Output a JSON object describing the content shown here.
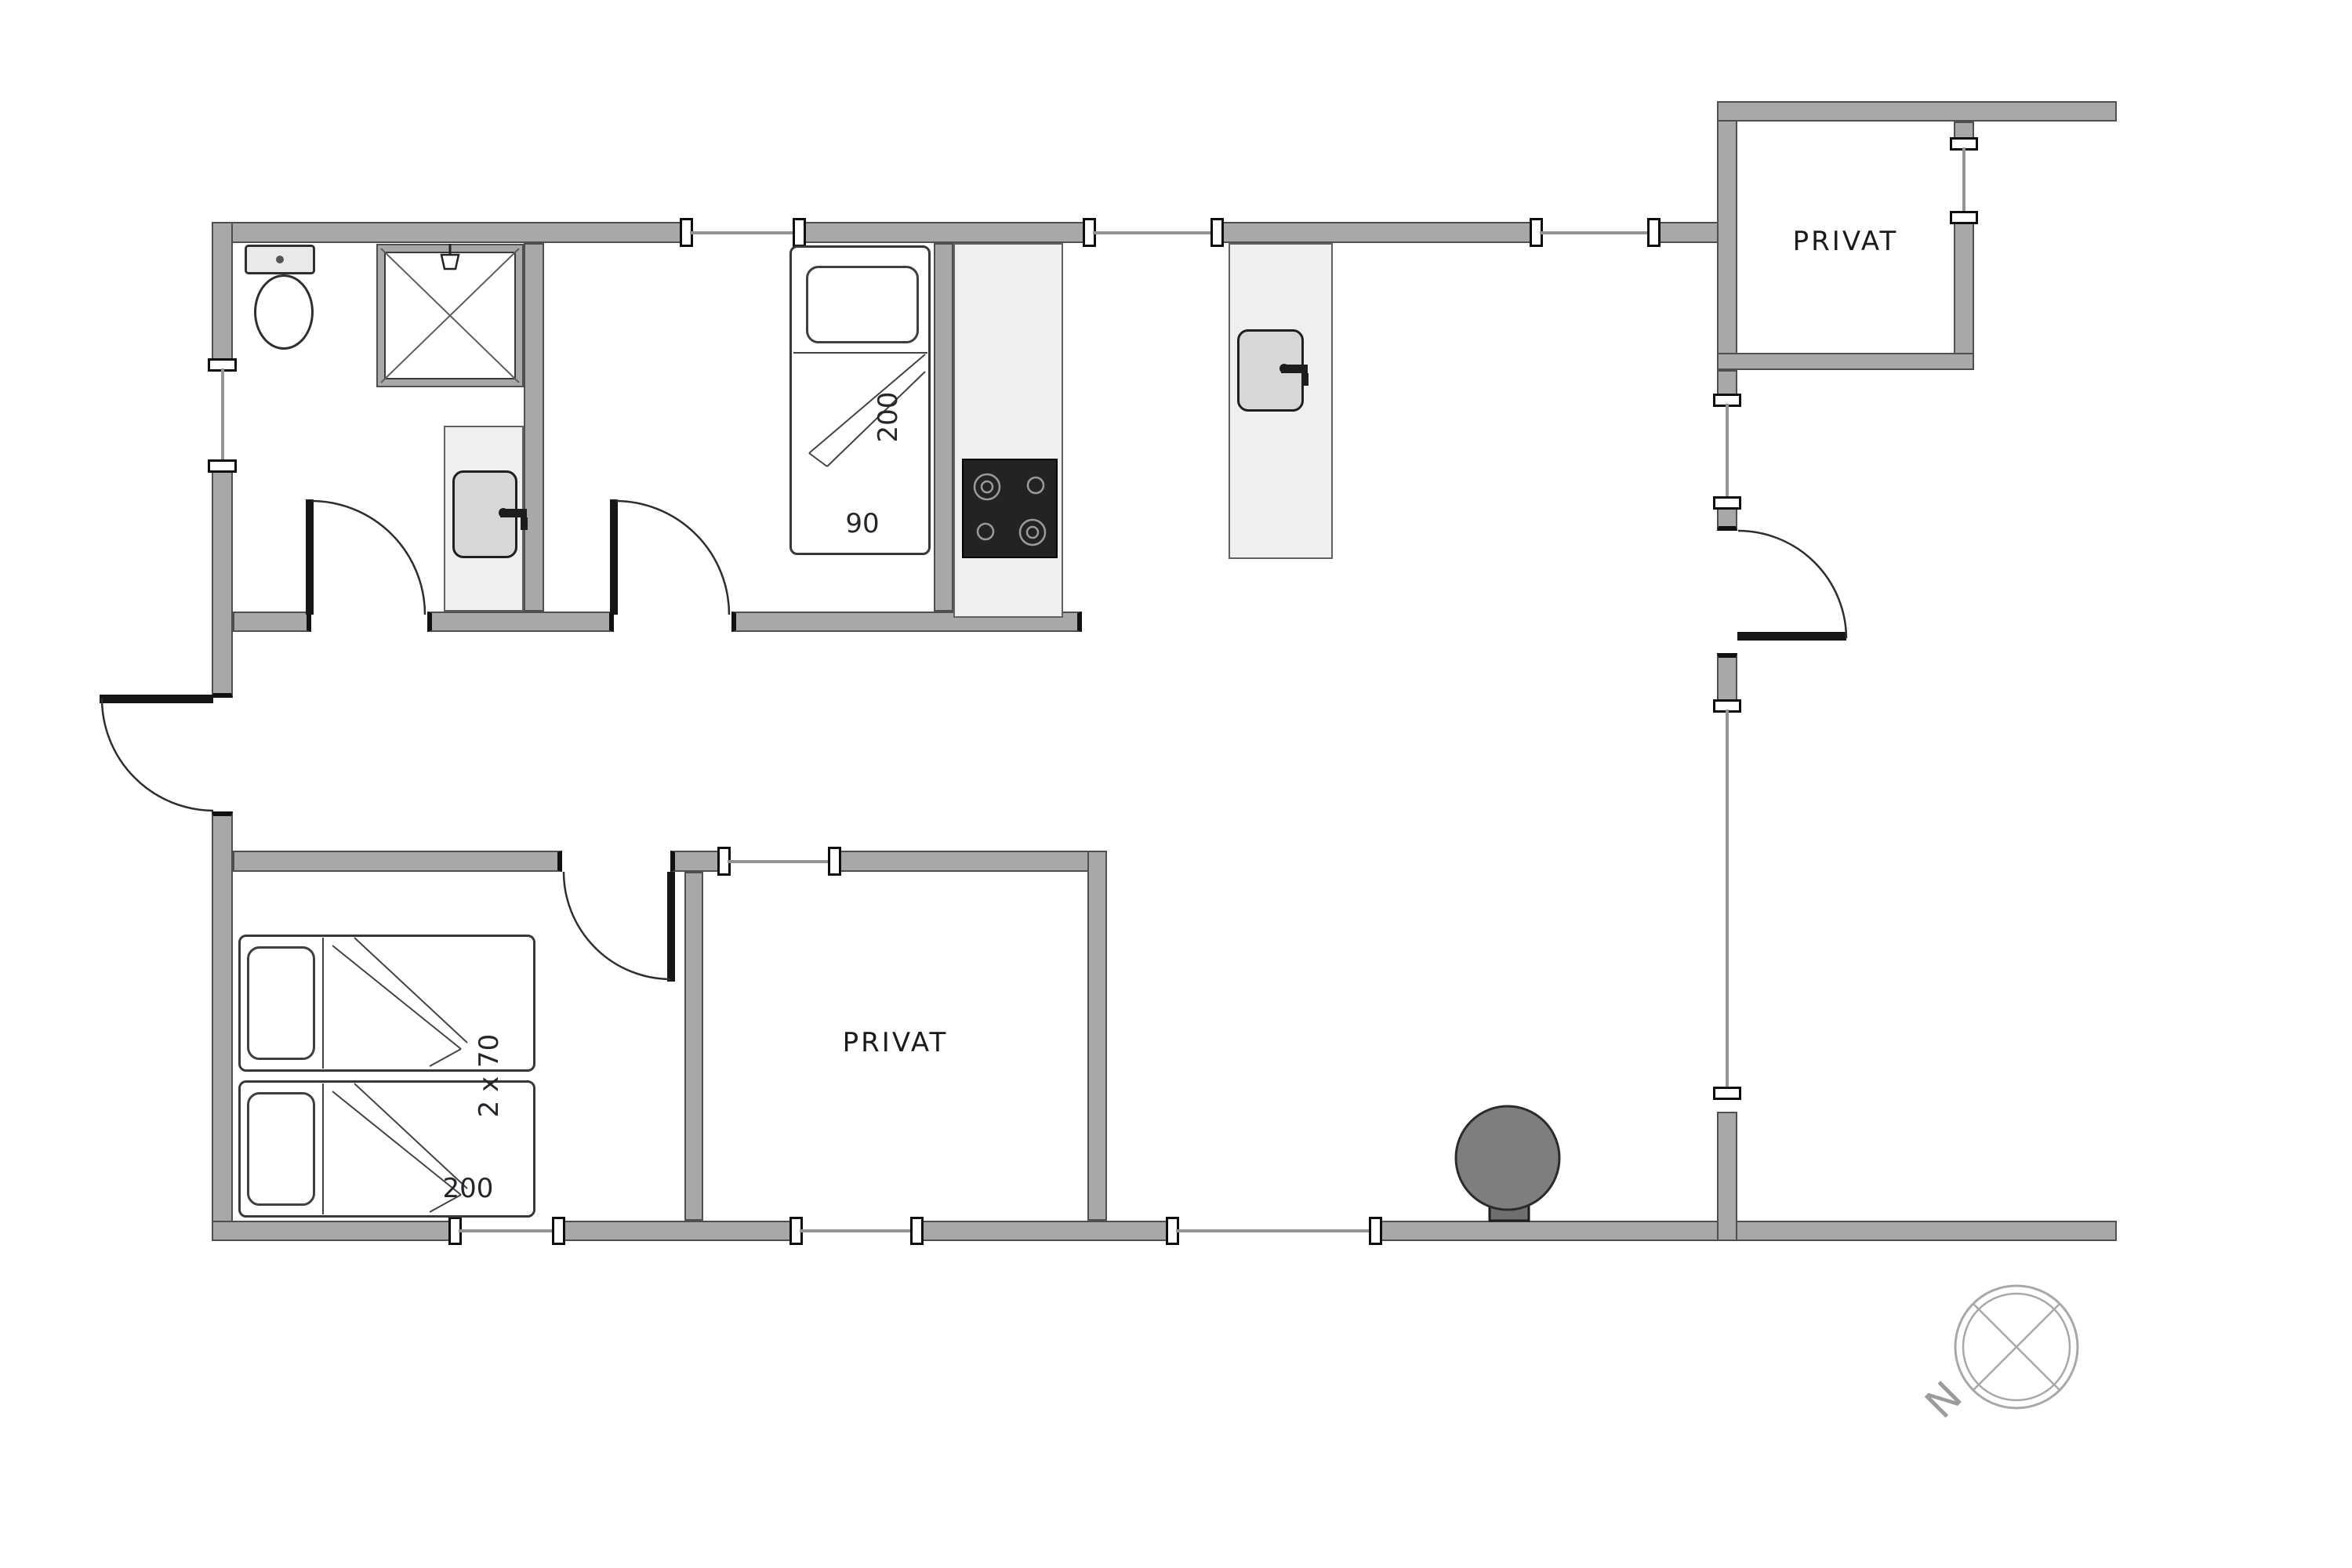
{
  "plan": {
    "title": "holiday-house floor plan",
    "rooms": [
      {
        "id": "annex",
        "label": "PRIVAT"
      },
      {
        "id": "middle",
        "label": "PRIVAT"
      }
    ],
    "dimensions": {
      "niche_bed_length": "200",
      "niche_bed_width": "90",
      "twin_beds_width": "2 x 70",
      "twin_beds_length": "200"
    },
    "compass": {
      "north_label": "N"
    },
    "colors": {
      "wall": "#a8a8a8",
      "wall_outline": "#4f4f4f",
      "counter": "#efefef",
      "cooktop": "#232323",
      "wood_stove": "#7e7e7e",
      "window_glass": "#949494",
      "text": "#1b1b1b",
      "compass": "#a8a8a8"
    },
    "icons": [
      "toilet-icon",
      "shower-icon",
      "sink-icon",
      "cooktop-icon",
      "bed-icon",
      "wood-stove-icon",
      "door-arc-icon",
      "window-icon",
      "compass-icon"
    ]
  }
}
